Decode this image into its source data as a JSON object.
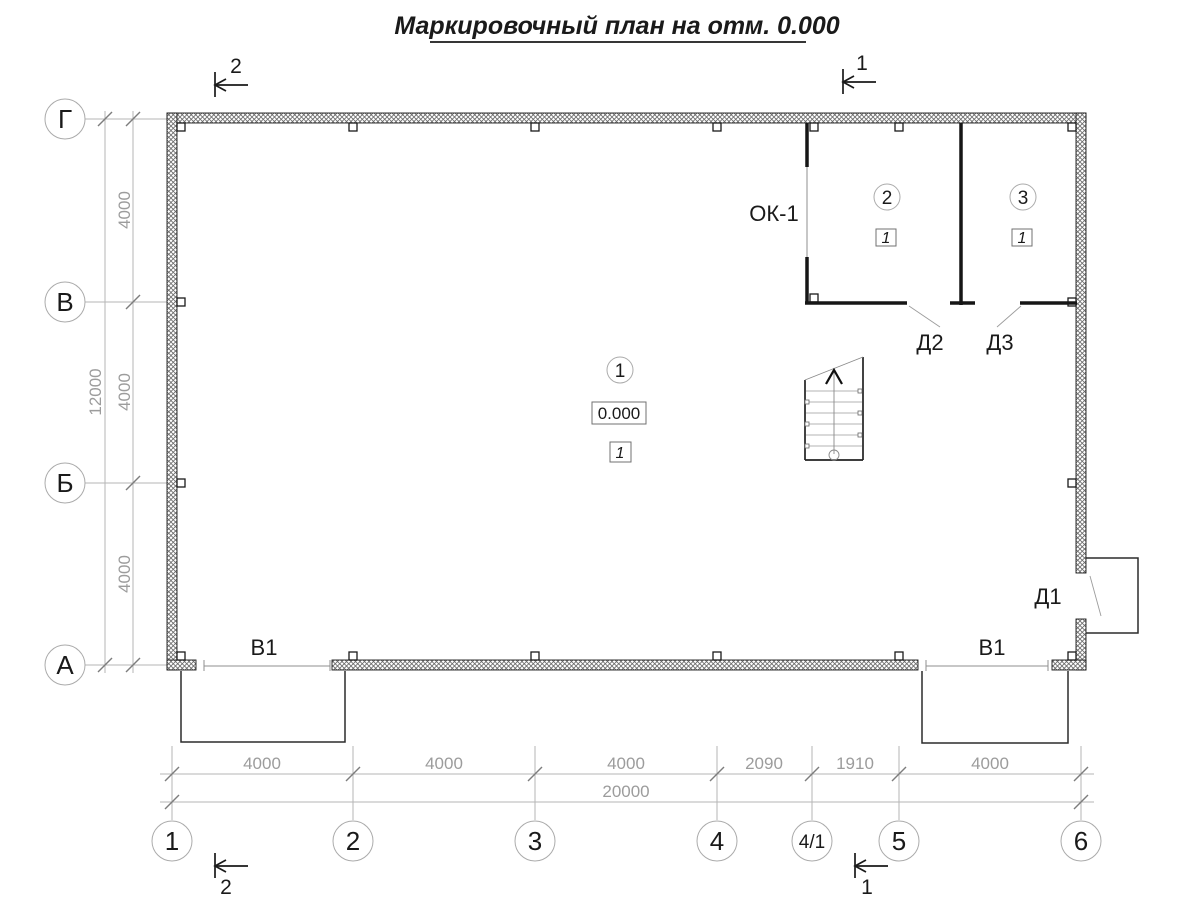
{
  "title": "Маркировочный план на отм. 0.000",
  "section_marks": {
    "top_left": "2",
    "top_right": "1",
    "bottom_left": "2",
    "bottom_right": "1"
  },
  "row_axes": {
    "g": "Г",
    "v": "В",
    "b": "Б",
    "a": "А"
  },
  "col_axes": {
    "c1": "1",
    "c2": "2",
    "c3": "3",
    "c4": "4",
    "c4_1": "4/1",
    "c5": "5",
    "c6": "6"
  },
  "dims": {
    "left_seg1": "4000",
    "left_seg2": "4000",
    "left_seg3": "4000",
    "left_total": "12000",
    "bot_seg1": "4000",
    "bot_seg2": "4000",
    "bot_seg3": "4000",
    "bot_seg4": "2090",
    "bot_seg5": "1910",
    "bot_seg6": "4000",
    "bot_total": "20000"
  },
  "labels": {
    "window_ok1": "ОК-1",
    "door_d1": "Д1",
    "door_d2": "Д2",
    "door_d3": "Д3",
    "gate_v1_left": "В1",
    "gate_v1_right": "В1"
  },
  "rooms": {
    "room1": {
      "number": "1",
      "elevation": "0.000",
      "floor_type": "1"
    },
    "room2": {
      "number": "2",
      "floor_type": "1"
    },
    "room3": {
      "number": "3",
      "floor_type": "1"
    }
  }
}
